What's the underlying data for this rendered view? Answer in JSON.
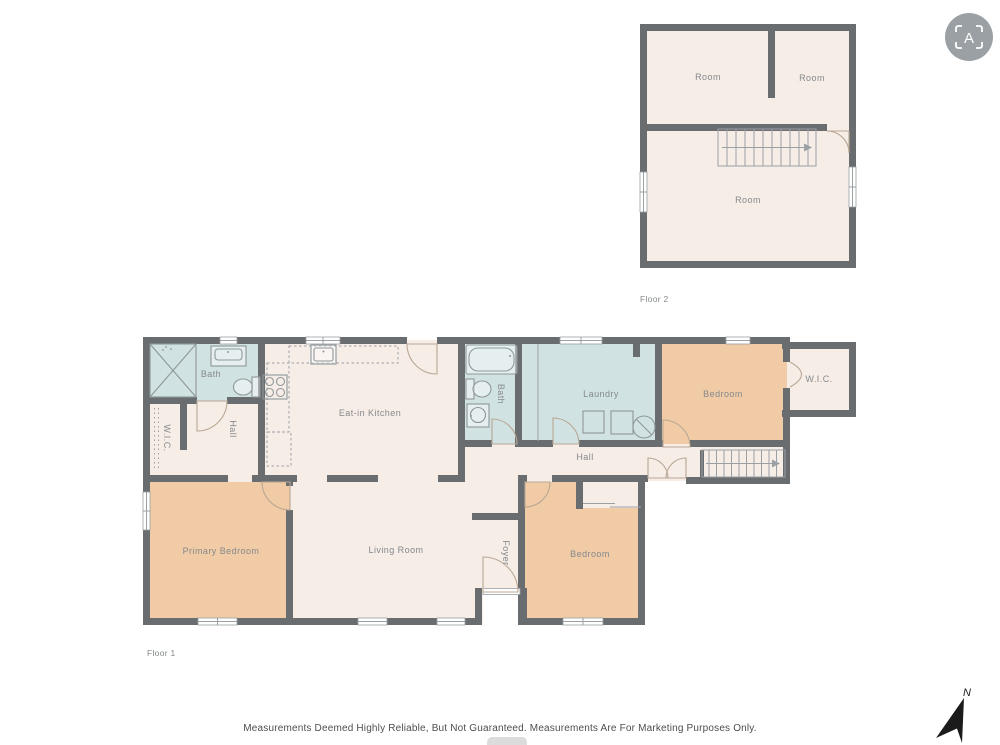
{
  "floor2": {
    "caption": "Floor 2",
    "rooms": [
      {
        "label": "Room"
      },
      {
        "label": "Room"
      },
      {
        "label": "Room"
      }
    ]
  },
  "floor1": {
    "caption": "Floor 1",
    "rooms": [
      {
        "label": "Bath"
      },
      {
        "label": "W.I.C."
      },
      {
        "label": "Hall"
      },
      {
        "label": "Eat-in Kitchen"
      },
      {
        "label": "Bath"
      },
      {
        "label": "Laundry"
      },
      {
        "label": "Bedroom"
      },
      {
        "label": "W.I.C."
      },
      {
        "label": "Hall"
      },
      {
        "label": "Primary Bedroom"
      },
      {
        "label": "Living Room"
      },
      {
        "label": "Foyer"
      },
      {
        "label": "Bedroom"
      }
    ]
  },
  "footer": {
    "disclaimer": "Measurements Deemed Highly Reliable, But Not Guaranteed. Measurements Are For Marketing Purposes Only."
  },
  "compass": {
    "label": "N"
  },
  "logo": {
    "letter": "A"
  },
  "colors": {
    "wall": "#696d70",
    "line": "#9aa0a4",
    "label": "#85898d",
    "door": "#b9a894",
    "cream": "#f6ede7",
    "teal": "#d1e2e2",
    "orange": "#f0cba5",
    "fixture": "#8e979b",
    "textdark": "#4e4e4e",
    "logobg": "#9aa0a4",
    "compass": "#1b1b1b",
    "pill": "#dcdcdc"
  }
}
